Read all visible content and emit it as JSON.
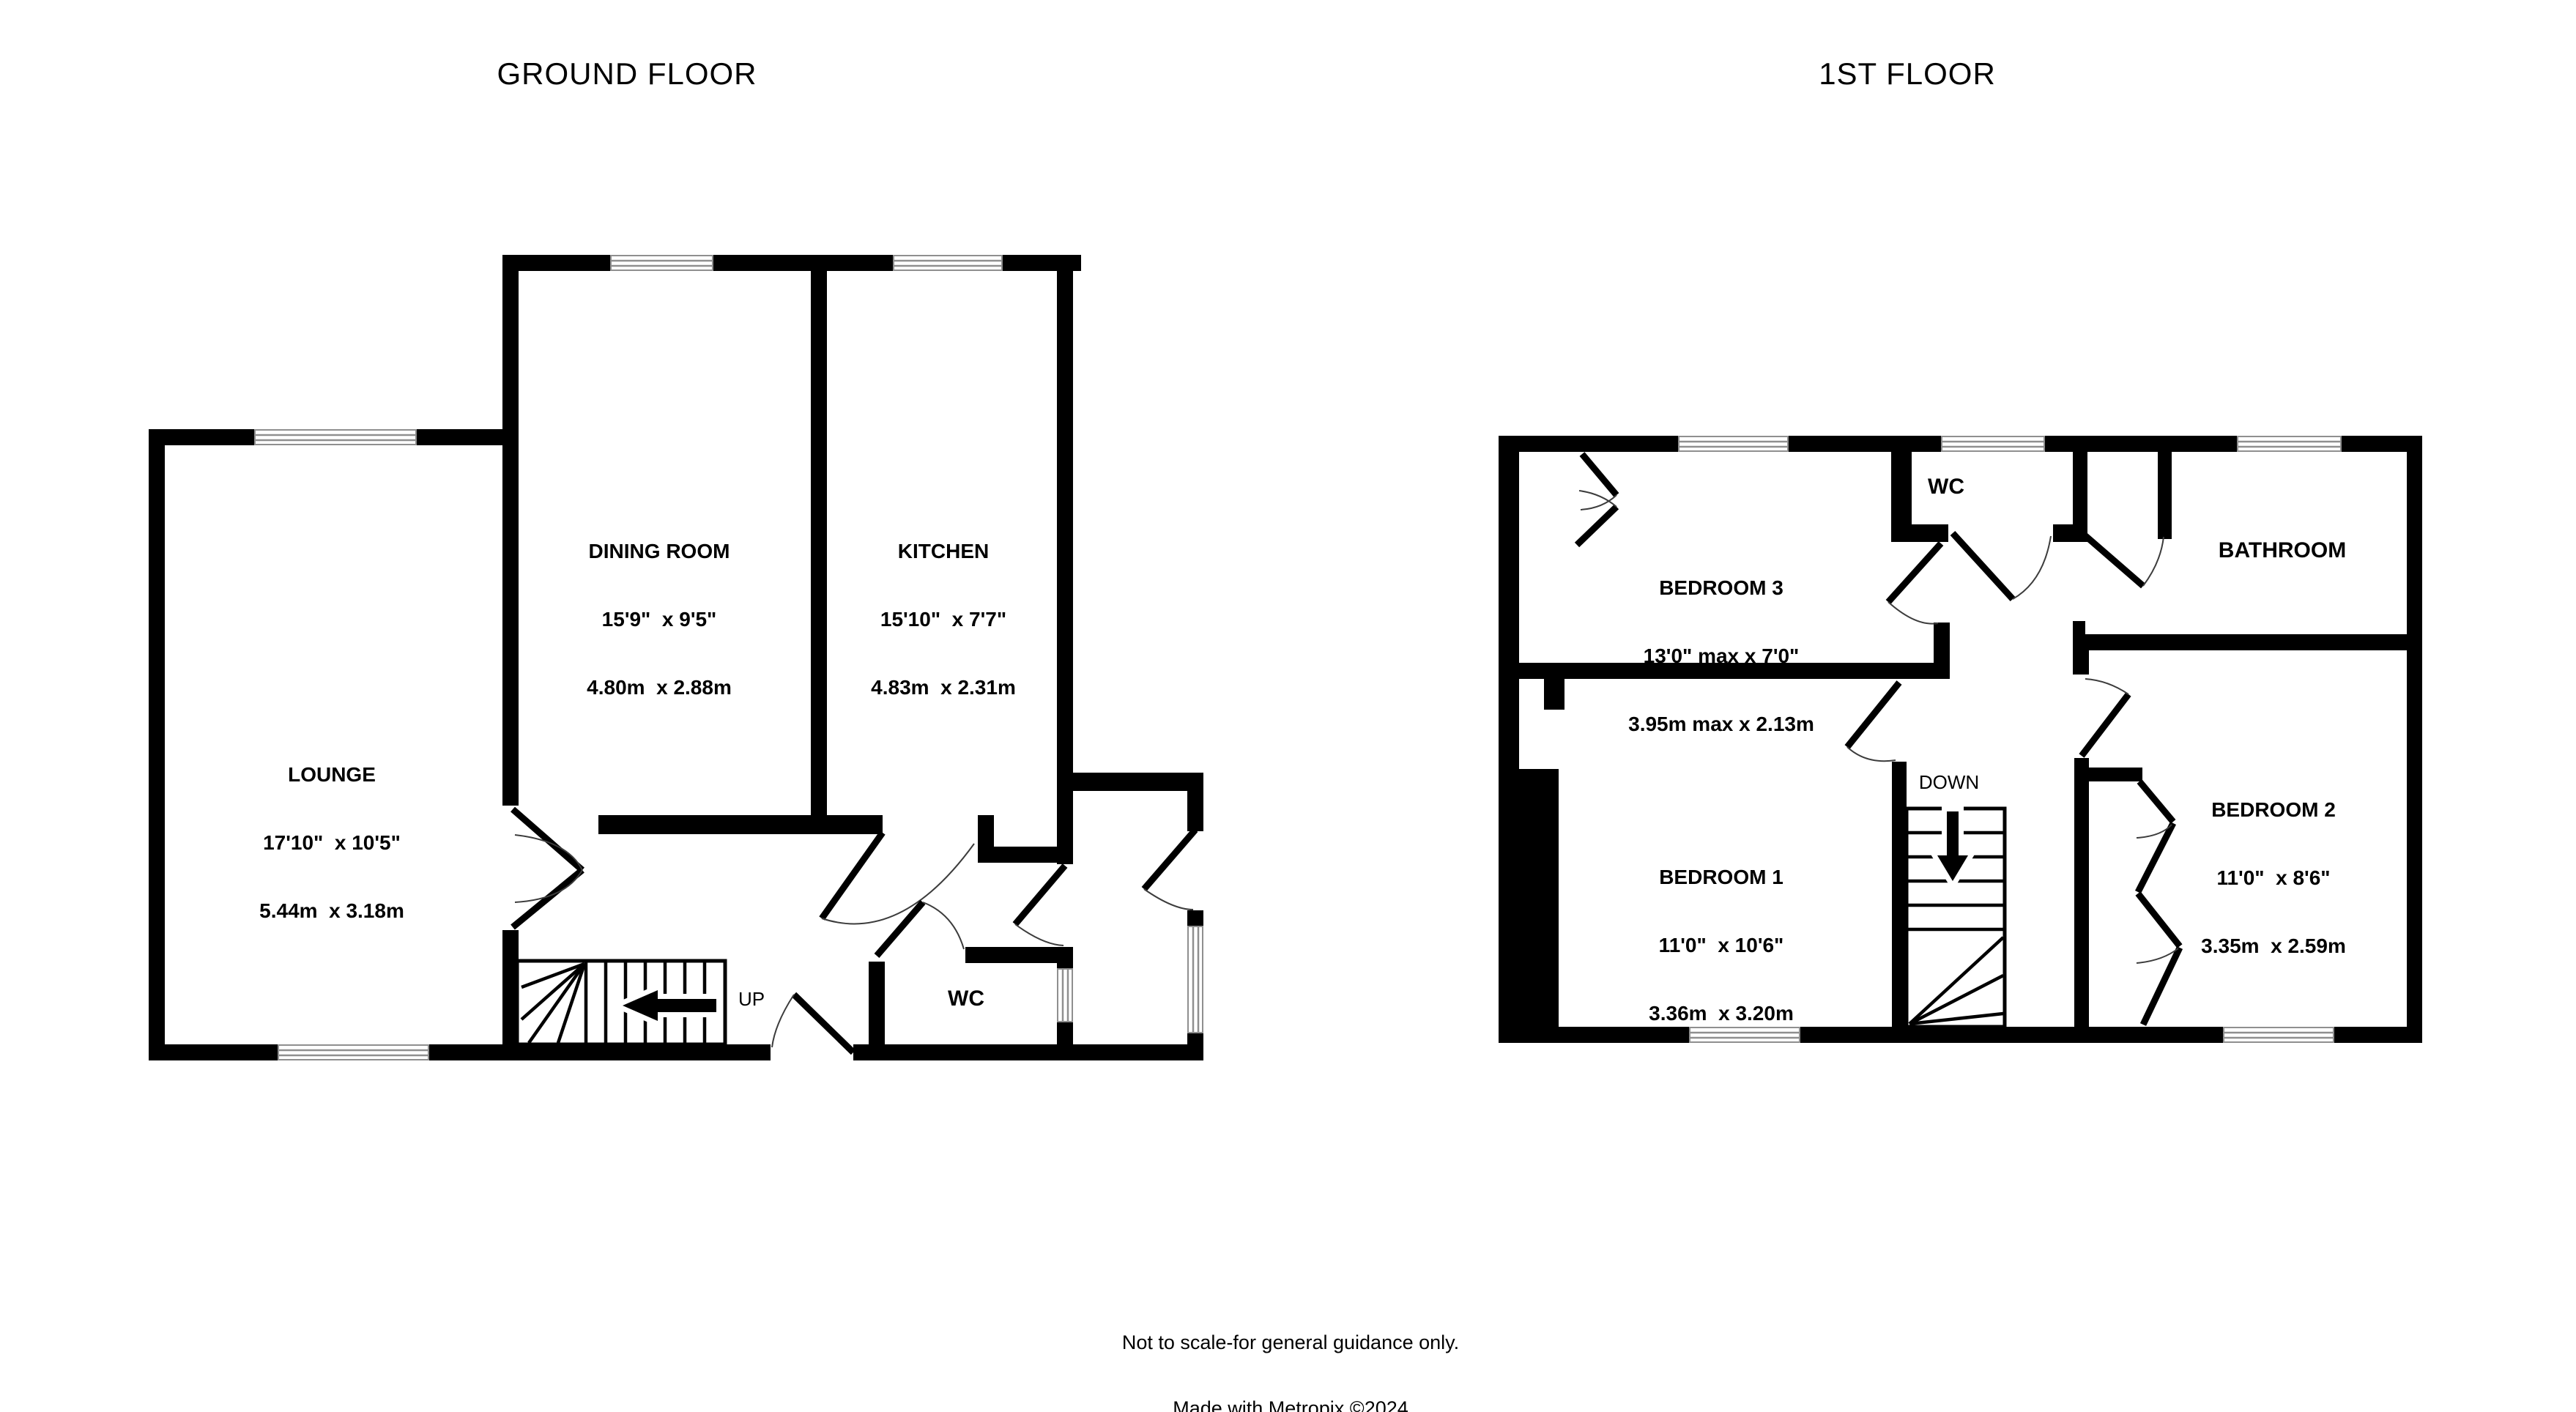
{
  "colors": {
    "wall": "#000000",
    "window": "#8f8f8f",
    "arc": "#3c3c3c"
  },
  "titles": {
    "ground_floor": "GROUND FLOOR",
    "first_floor": "1ST FLOOR"
  },
  "rooms": {
    "lounge": {
      "name": "LOUNGE",
      "imperial": "17'10\"  x 10'5\"",
      "metric": "5.44m  x 3.18m"
    },
    "dining": {
      "name": "DINING ROOM",
      "imperial": "15'9\"  x 9'5\"",
      "metric": "4.80m  x 2.88m"
    },
    "kitchen": {
      "name": "KITCHEN",
      "imperial": "15'10\"  x 7'7\"",
      "metric": "4.83m  x 2.31m"
    },
    "wc_ground": {
      "name": "WC"
    },
    "bedroom1": {
      "name": "BEDROOM 1",
      "imperial": "11'0\"  x 10'6\"",
      "metric": "3.36m  x 3.20m"
    },
    "bedroom2": {
      "name": "BEDROOM 2",
      "imperial": "11'0\"  x 8'6\"",
      "metric": "3.35m  x 2.59m"
    },
    "bedroom3": {
      "name": "BEDROOM 3",
      "imperial": "13'0\" max x 7'0\"",
      "metric": "3.95m max x 2.13m"
    },
    "wc_first": {
      "name": "WC"
    },
    "bathroom": {
      "name": "BATHROOM"
    }
  },
  "stairs": {
    "up_label": "UP",
    "down_label": "DOWN"
  },
  "footer": {
    "line1": "Not to scale-for general guidance only.",
    "line2": "Made with Metropix ©2024"
  }
}
